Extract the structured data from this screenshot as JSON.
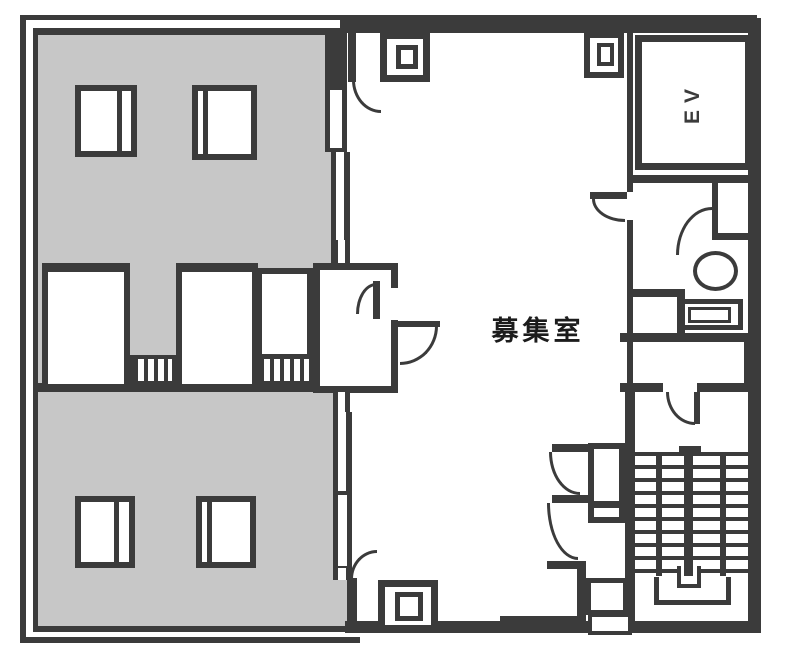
{
  "plan": {
    "labels": {
      "vacant_room": "募集室",
      "elevator": "EV"
    },
    "colors": {
      "wall": "#3b3b3b",
      "shaded_area": "#c7c7c7",
      "background": "#ffffff"
    }
  }
}
